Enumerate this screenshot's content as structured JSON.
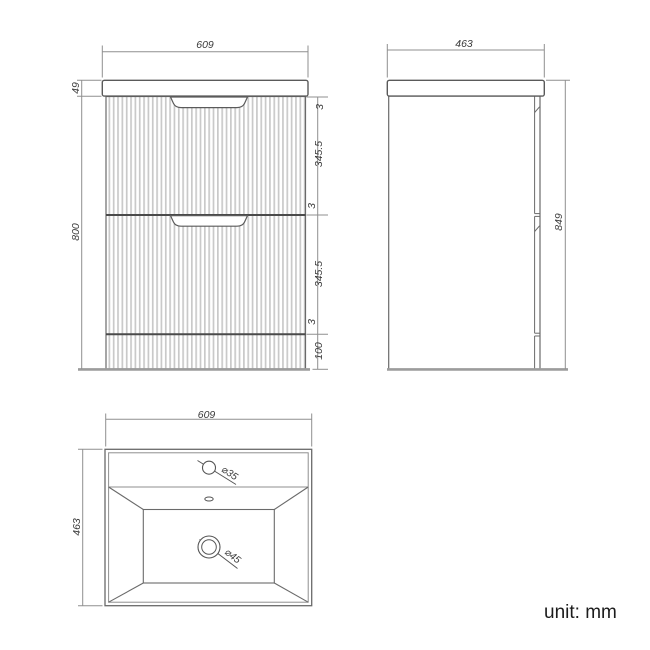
{
  "unit_note": "unit: mm",
  "colors": {
    "object_line": "#6a6a6a",
    "dark_line": "#4a4a4a",
    "dimension_line": "#8f8f8f",
    "floor_line": "#9c9c9c",
    "flute_stripe": "#c9c9c9",
    "text": "#3a3a3a",
    "background": "#ffffff"
  },
  "views": {
    "front": {
      "width": "609",
      "worktop_height": "49",
      "cabinet_height": "800",
      "segments": [
        "3",
        "345.5",
        "3",
        "345.5",
        "3",
        "100"
      ]
    },
    "side": {
      "depth": "463",
      "total_height": "849"
    },
    "basin": {
      "width": "609",
      "depth": "463",
      "tap_hole": "⌀35",
      "waste_hole": "⌀45"
    }
  }
}
